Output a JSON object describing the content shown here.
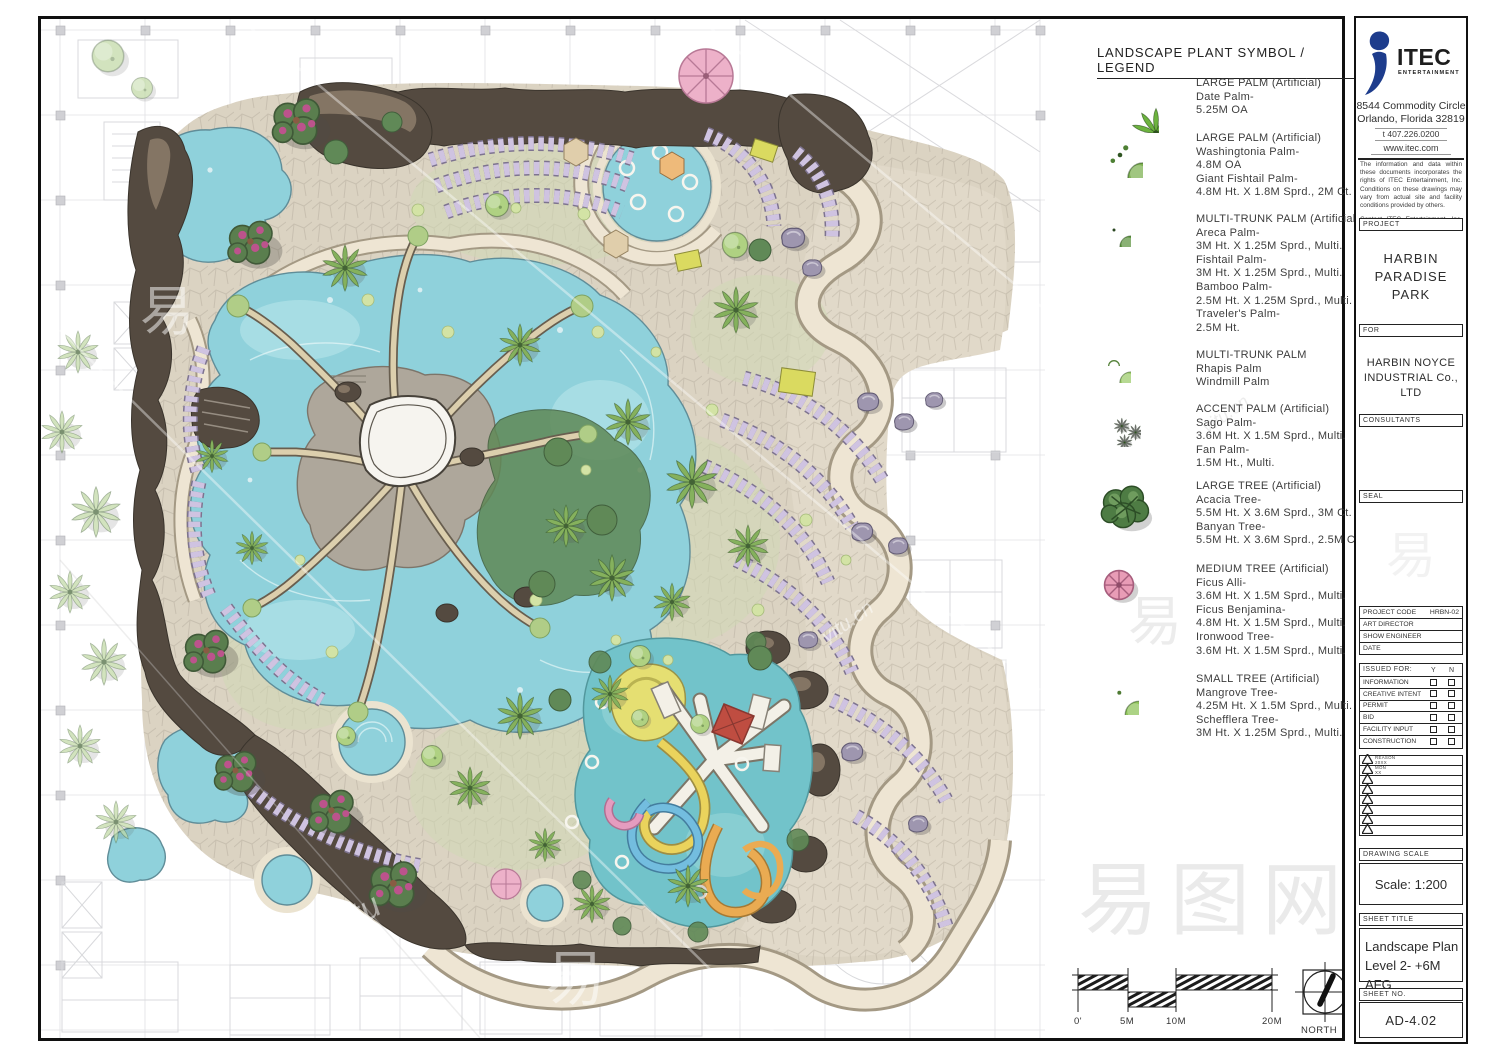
{
  "legend": {
    "title": "LANDSCAPE PLANT SYMBOL / LEGEND",
    "entries": [
      {
        "icon": "date-palm-icon",
        "text": "LARGE PALM (Artificial)\nDate Palm-\n5.25M OA"
      },
      {
        "icon": "washingtonia-palm-icon",
        "text": "LARGE PALM (Artificial)\nWashingtonia Palm-\n4.8M OA\nGiant Fishtail Palm-\n4.8M Ht. X 1.8M Sprd., 2M Ct."
      },
      {
        "icon": "areca-palm-icon",
        "text": "MULTI-TRUNK PALM (Artificial)\nAreca Palm-\n3M Ht. X 1.25M Sprd., Multi.\nFishtail Palm-\n3M Ht. X 1.25M Sprd., Multi.\nBamboo Palm-\n2.5M Ht. X 1.25M Sprd., Multi.\nTraveler's Palm-\n2.5M Ht."
      },
      {
        "icon": "rhapis-palm-icon",
        "text": "MULTI-TRUNK PALM\nRhapis Palm\nWindmill Palm"
      },
      {
        "icon": "sago-palm-icon",
        "text": "ACCENT PALM (Artificial)\nSago Palm-\n3.6M Ht. X 1.5M Sprd., Multi.\nFan Palm-\n1.5M Ht., Multi."
      },
      {
        "icon": "large-tree-icon",
        "text": "LARGE TREE (Artificial)\nAcacia Tree-\n5.5M Ht. X 3.6M Sprd., 3M Ct.\nBanyan Tree-\n5.5M Ht. X 3.6M Sprd., 2.5M Ct."
      },
      {
        "icon": "medium-tree-icon",
        "text": "MEDIUM TREE (Artificial)\nFicus Alli-\n3.6M Ht. X 1.5M Sprd., Multi.\nFicus Benjamina-\n4.8M Ht. X 1.5M Sprd., Multi.\nIronwood Tree-\n3.6M Ht. X 1.5M Sprd., Multi."
      },
      {
        "icon": "small-tree-icon",
        "text": "SMALL TREE (Artificial)\nMangrove Tree-\n4.25M Ht. X 1.5M Sprd., Multi.\nSchefflera Tree-\n3M Ht. X 1.25M Sprd., Multi."
      }
    ]
  },
  "titleblock": {
    "logo": {
      "name": "ITEC",
      "sub": "ENTERTAINMENT",
      "brand_color": "#1d3c8c"
    },
    "address_line1": "8544 Commodity Circle",
    "address_line2": "Orlando, Florida 32819",
    "phone": "t 407.226.0200",
    "website": "www.itec.com",
    "disclaimer1": "The information and data within these documents incorporates the rights of ITEC Entertainment, Inc. Conditions on these drawings may vary from actual site and facility conditions provided by others.",
    "disclaimer2": "Contact ITEC Entertainment, Inc. for clarifications.",
    "project_label": "PROJECT",
    "project_name": "HARBIN\nPARADISE\nPARK",
    "for_label": "FOR",
    "client_name": "HARBIN NOYCE\nINDUSTRIAL Co., LTD",
    "consultants_label": "CONSULTANTS",
    "seal_label": "SEAL",
    "fields": [
      {
        "label": "PROJECT CODE",
        "value": "HRBN-02"
      },
      {
        "label": "ART DIRECTOR",
        "value": ""
      },
      {
        "label": "SHOW ENGINEER",
        "value": ""
      },
      {
        "label": "DATE",
        "value": ""
      }
    ],
    "issued_for": {
      "label": "ISSUED FOR:",
      "col_y": "Y",
      "col_n": "N",
      "rows": [
        "INFORMATION",
        "CREATIVE INTENT",
        "PERMIT",
        "BID",
        "FACILITY INPUT",
        "CONSTRUCTION"
      ]
    },
    "revisions": [
      {
        "line1": "REASON",
        "line2": "20XX"
      },
      {
        "line1": "MON",
        "line2": "XX"
      },
      {},
      {},
      {},
      {},
      {},
      {}
    ],
    "drawing_scale_label": "DRAWING SCALE",
    "drawing_scale": "Scale: 1:200",
    "sheet_title_label": "SHEET TITLE",
    "sheet_title": "Landscape Plan\nLevel 2-  +6M AFG",
    "sheet_no_label": "SHEET NO.",
    "sheet_no": "AD-4.02"
  },
  "scalebar": {
    "labels": [
      "0'",
      "5M",
      "10M",
      "20M"
    ]
  },
  "north": {
    "label": "NORTH"
  },
  "watermarks": {
    "big": "易图网",
    "glyph": "易",
    "script": "yitu",
    "script2": "yitu.cn"
  }
}
